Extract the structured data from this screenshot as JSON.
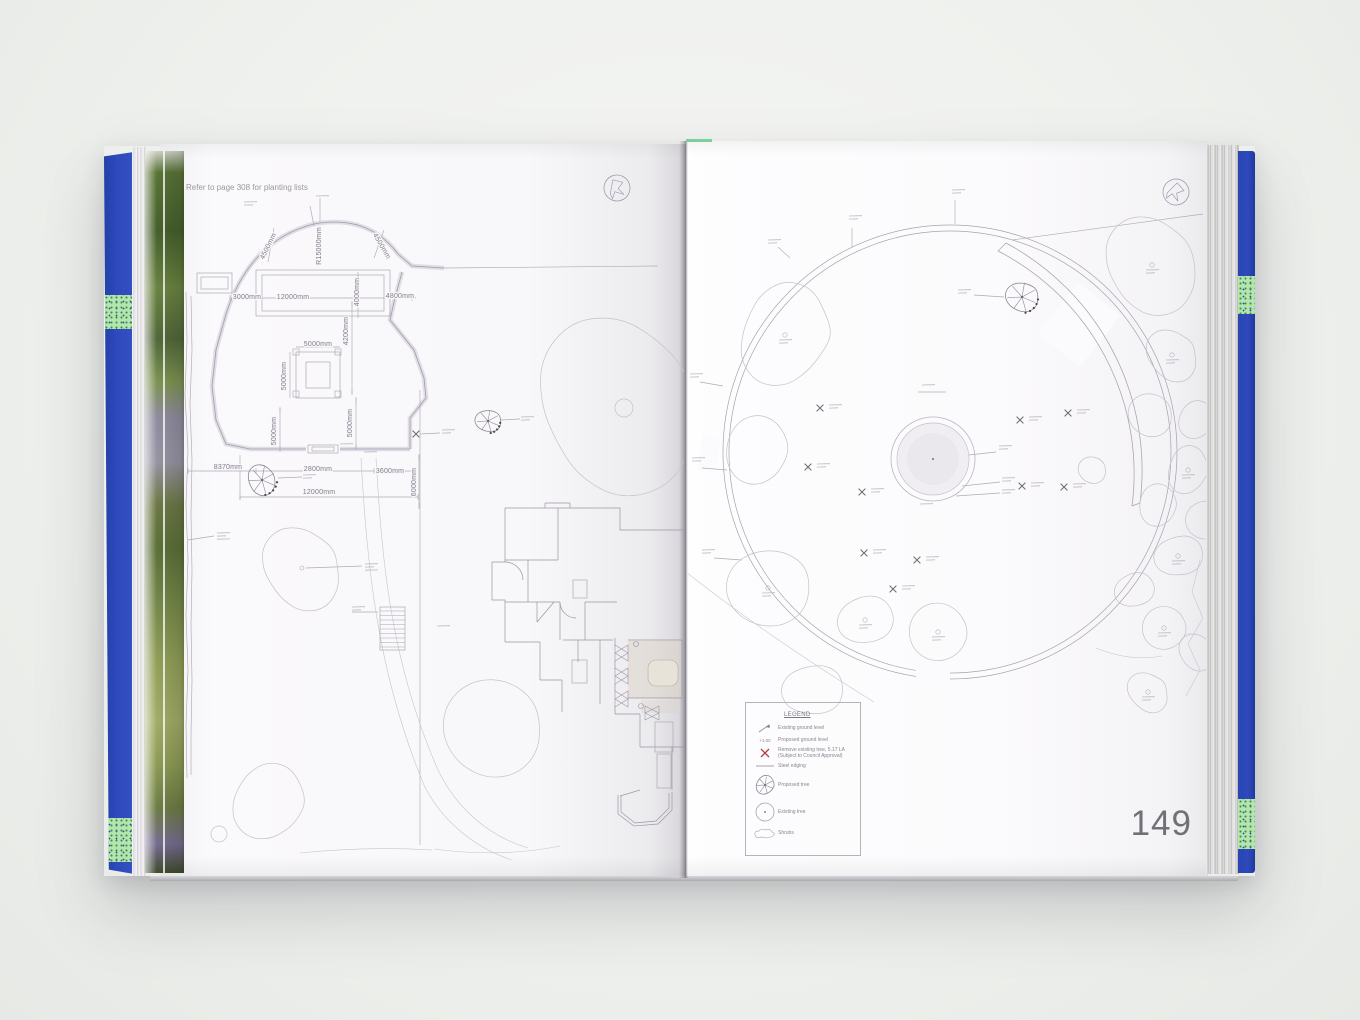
{
  "book": {
    "left_page": {
      "header_note": "Refer to page 308 for planting lists",
      "dimension_labels": [
        {
          "text": "4500mm",
          "x": 270,
          "y": 247,
          "rot": -64
        },
        {
          "text": "R15000mm",
          "x": 321,
          "y": 246,
          "rot": -90
        },
        {
          "text": "4500mm",
          "x": 380,
          "y": 247,
          "rot": 60
        },
        {
          "text": "3000mm",
          "x": 247,
          "y": 299,
          "rot": 0
        },
        {
          "text": "12000mm",
          "x": 293,
          "y": 299,
          "rot": 0
        },
        {
          "text": "4000mm",
          "x": 359,
          "y": 292,
          "rot": -90
        },
        {
          "text": "4800mm",
          "x": 400,
          "y": 298,
          "rot": 0
        },
        {
          "text": "4200mm",
          "x": 348,
          "y": 331,
          "rot": -90
        },
        {
          "text": "5000mm",
          "x": 318,
          "y": 346,
          "rot": 0
        },
        {
          "text": "5000mm",
          "x": 286,
          "y": 376,
          "rot": -90
        },
        {
          "text": "5000mm",
          "x": 352,
          "y": 423,
          "rot": -90
        },
        {
          "text": "5000mm",
          "x": 276,
          "y": 431,
          "rot": -90
        },
        {
          "text": "8370mm",
          "x": 228,
          "y": 469,
          "rot": 0
        },
        {
          "text": "2800mm",
          "x": 318,
          "y": 471,
          "rot": 0
        },
        {
          "text": "3600mm",
          "x": 390,
          "y": 473,
          "rot": 0
        },
        {
          "text": "6000mm",
          "x": 416,
          "y": 482,
          "rot": -90
        },
        {
          "text": "12000mm",
          "x": 319,
          "y": 494,
          "rot": 0
        }
      ]
    },
    "right_page": {
      "page_number": "149",
      "legend": {
        "title": "LEGEND",
        "items": [
          {
            "icon": "existing-ground-level-icon",
            "label": "Existing ground level"
          },
          {
            "icon": "proposed-ground-level-icon",
            "label": "Proposed ground level"
          },
          {
            "icon": "remove-tree-icon",
            "label": "Remove existing tree, 5.17 LA (Subject to Council Approval)"
          },
          {
            "icon": "steel-edging-icon",
            "label": "Steel edging"
          },
          {
            "icon": "proposed-tree-icon",
            "label": "Proposed tree"
          },
          {
            "icon": "existing-tree-icon",
            "label": "Existing tree"
          },
          {
            "icon": "shrubs-icon",
            "label": "Shrubs"
          }
        ]
      }
    },
    "colors": {
      "cover_blue": "#2d49bb",
      "remove_red": "#b23a3a",
      "plan_line": "#a8a1af"
    }
  }
}
